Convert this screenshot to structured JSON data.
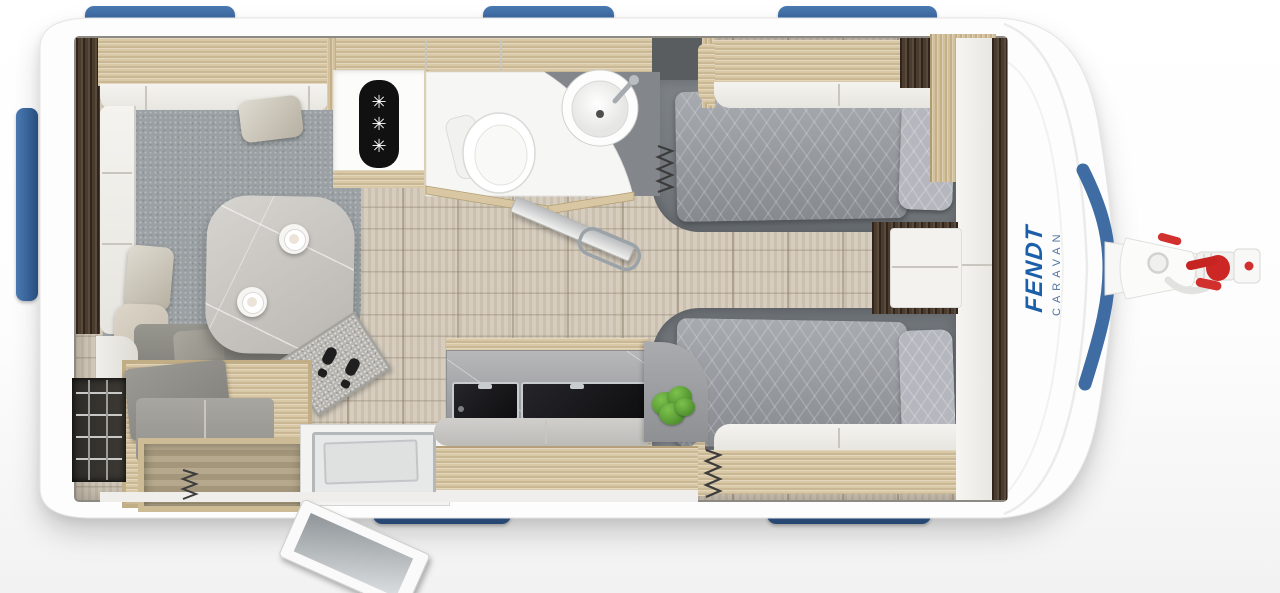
{
  "title": "Fendt caravan floor plan - top view",
  "branding": {
    "brand": "FENDT",
    "model_line": "CARAVAN",
    "brand_color": "#1b5fa9"
  },
  "colors": {
    "window_frame_blue": "#3e6ca3",
    "hitch_accent_red": "#d2302c",
    "body_white": "#fdfdfd",
    "floor_wood": "#d2c9ba",
    "carpet_gray": "#9aa0a3",
    "bedding_gray": "#999da3",
    "worktop_gray": "#a7a8aa",
    "light_wood": "#d9c8a6",
    "dark_wood": "#4c3c2d"
  },
  "fridge": {
    "symbols": [
      "✳",
      "✳",
      "✳"
    ]
  },
  "floorplan": {
    "orientation": "tow hitch on the right",
    "windows": {
      "top": 3,
      "bottom": 2,
      "rear": 1
    },
    "areas": [
      {
        "name": "front-lounge",
        "items": [
          "u-shaped-sofa",
          "back-cushions",
          "rounded-table",
          "two-coffee-cups",
          "doormat",
          "carpet"
        ]
      },
      {
        "name": "entry",
        "items": [
          "bench-seat",
          "open-storage-drawer",
          "wire-storage-rack",
          "step-tray",
          "open-entry-door"
        ]
      },
      {
        "name": "washroom",
        "items": [
          "toilet",
          "corner-washbasin",
          "open-washroom-door",
          "towel-rail",
          "refrigerator"
        ]
      },
      {
        "name": "kitchen",
        "items": [
          "covered-sink",
          "covered-hob",
          "worktop",
          "drawer-unit",
          "houseplant",
          "curved-partition"
        ]
      },
      {
        "name": "bedroom",
        "items": [
          "single-bed-top",
          "single-bed-bottom",
          "pillows",
          "bedside-chest",
          "wardrobe",
          "overhead-lockers",
          "bed-slat-springs"
        ]
      },
      {
        "name": "exterior",
        "items": [
          "tow-hitch",
          "hitch-handles",
          "window-frames"
        ]
      }
    ]
  }
}
